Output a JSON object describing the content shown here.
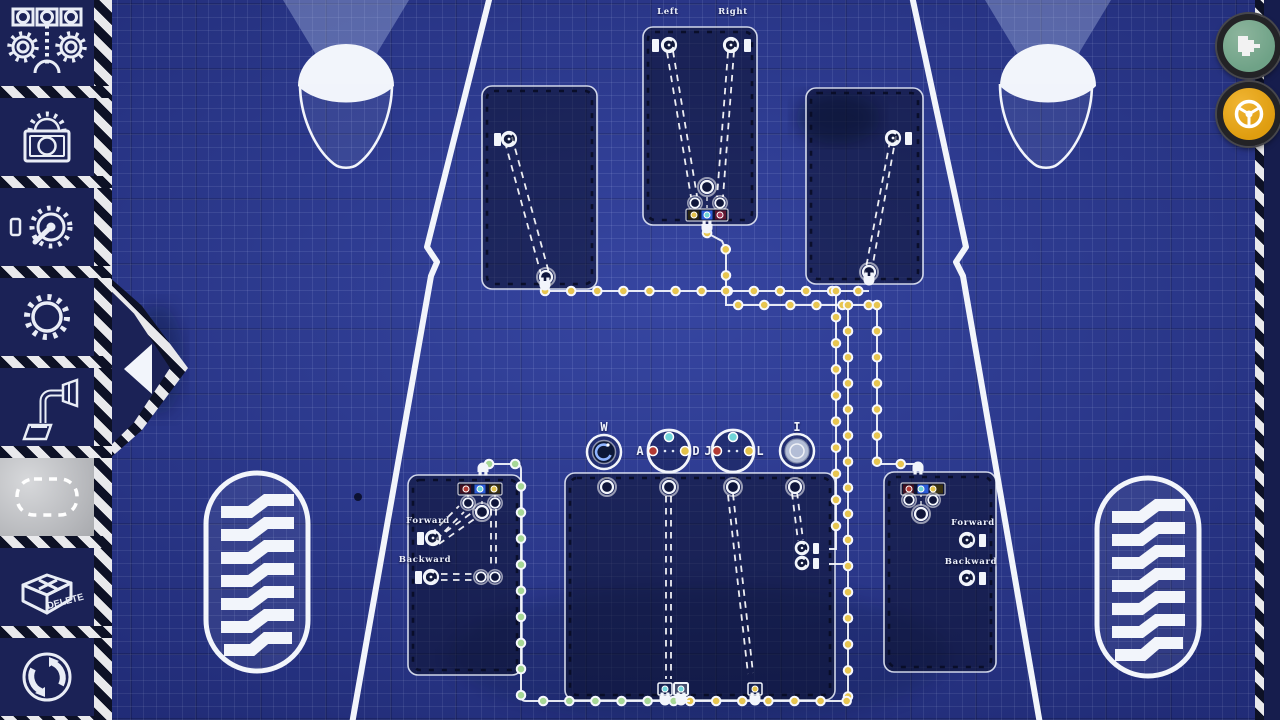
{
  "colors": {
    "blueprint_bg": "#2c3a96",
    "sidebar_navy": "#1b2256",
    "wire_yellow": "#e7c550",
    "wire_green": "#a6d796",
    "dot_cyan": "#6fd4d8",
    "dot_red": "#b23a33",
    "dot_yellow": "#e3c24a",
    "dot_magenta": "#a43556",
    "button_green": "#6fa287",
    "button_orange": "#df9d0f"
  },
  "sidebar": {
    "tools": [
      "assembly",
      "lock",
      "motor-dial",
      "gear",
      "connector",
      "selection",
      "delete",
      "reset"
    ],
    "selected_tool": "selection",
    "delete_label": "DELETE"
  },
  "hud": {
    "pointer_button": "pointer-mode",
    "drive_button": "drive-mode"
  },
  "blueprint": {
    "steering_panel": {
      "left_label": "Left",
      "right_label": "Right"
    },
    "left_drive_panel": {
      "forward_label": "Forward",
      "backward_label": "Backward"
    },
    "right_drive_panel": {
      "forward_label": "Forward",
      "backward_label": "Backward"
    },
    "key_bindings": {
      "throttle": "W",
      "steer_left": "A",
      "steer_right": "D",
      "aux_left": "J",
      "aux_right": "L",
      "brake": "I"
    }
  }
}
